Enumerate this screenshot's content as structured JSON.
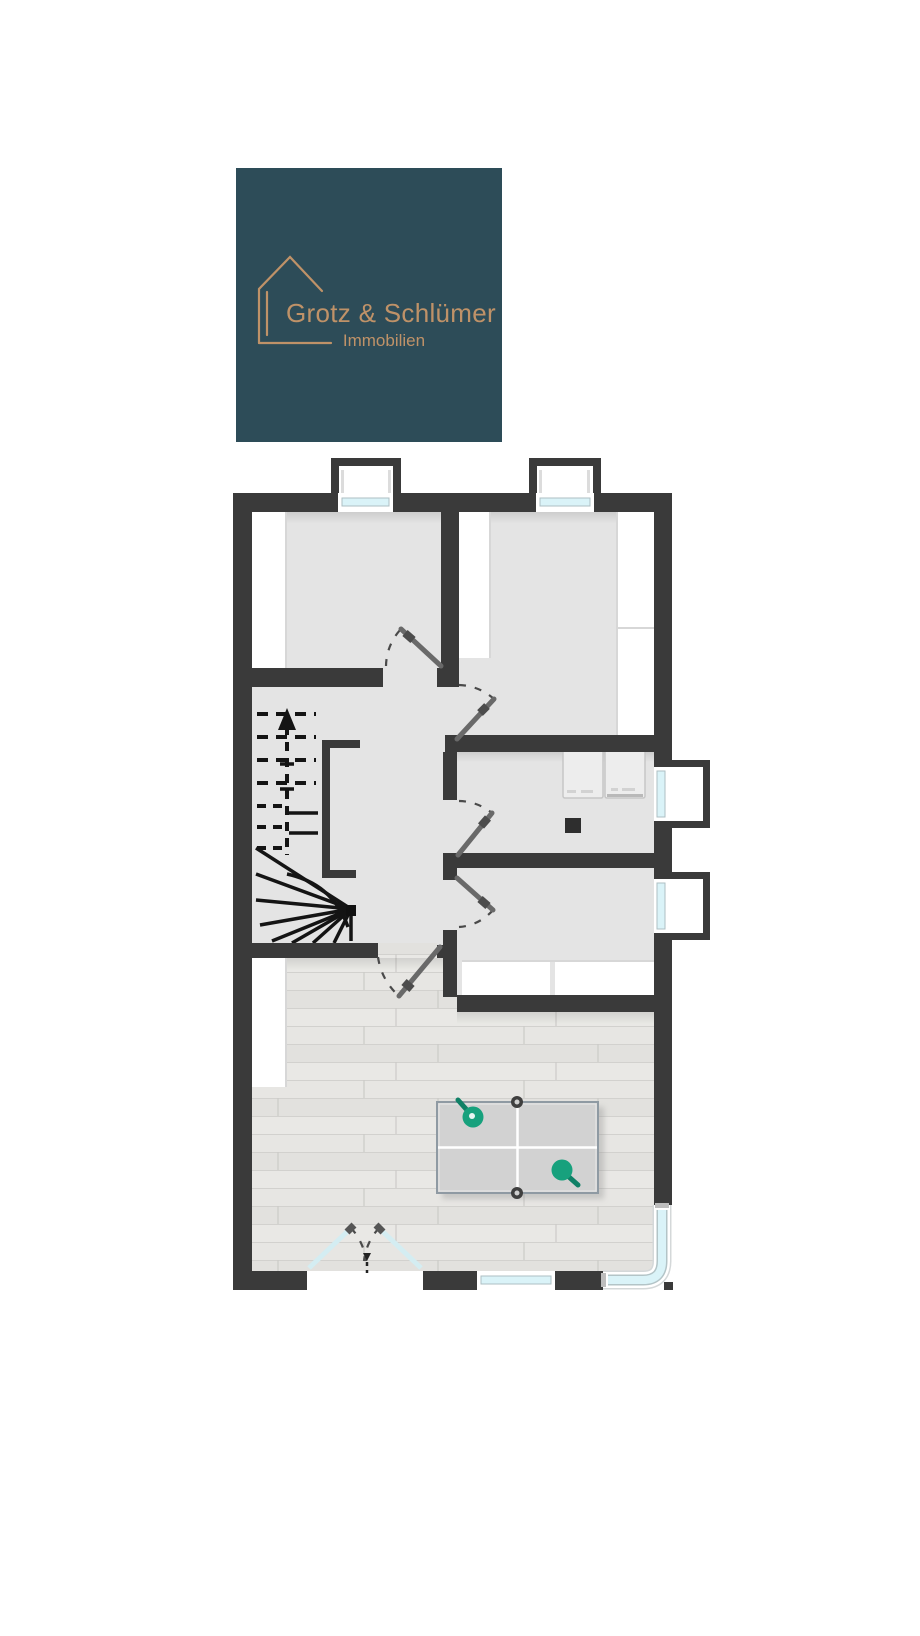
{
  "logo": {
    "company": "Grotz & Schlümer",
    "subtitle": "Immobilien"
  },
  "colors": {
    "brand-bg": "#2d4c58",
    "brand-fg": "#bf9268",
    "wall-color": "#3a3a3a",
    "floor-color": "#e4e4e4",
    "wood-base": "#e7e6e3",
    "glass-color": "#daf3f8",
    "paddle-green": "#17a17d",
    "table-gray": "#d2d2d2",
    "tread-black": "#141414"
  },
  "floorplan": {
    "icons": {
      "house-outline-icon": "line house in logo",
      "staircase-icon": "winder staircase with dashed upper flight and up arrow",
      "table-tennis-table-icon": "gray table with white lines, net posts and two green paddles",
      "washer-icon": "appliance square against wall",
      "dryer-icon": "appliance square against wall",
      "chimney-icon": "small dark square flue",
      "dormer-window-count-top": 2,
      "side-window-count-right": 2,
      "french-double-door": "glazed double door swinging inward at bottom wall",
      "bottom-window-count": 1,
      "corner-window": "glazing wrapping the bottom-right corner",
      "interior-door-count": 5
    }
  }
}
